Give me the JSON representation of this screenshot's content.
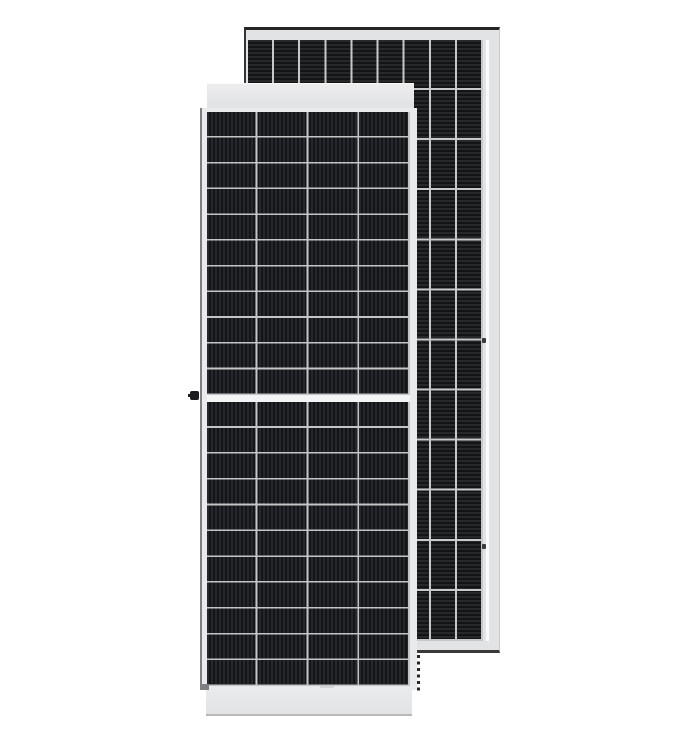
{
  "scene": {
    "type": "product-photo",
    "subject": "Two monocrystalline half-cut-cell solar photovoltaic modules; front-face panel standing in front of a rear-face panel",
    "background": "#ffffff"
  },
  "front_panel": {
    "view": "front glass face with white aluminium frame, top and bottom frame faces visible in perspective",
    "cell_columns": 4,
    "cell_rows_top_half": 11,
    "cell_rows_bottom_half": 11,
    "center_split": "horizontal white gap between upper and lower half-cell strings",
    "grounding_knob": "small black fitting on left frame edge at the center split"
  },
  "rear_panel": {
    "view": "rear side with dark cell matrix visible, light frame on right and bottom, dark outline on top and left",
    "cell_columns": 9,
    "cell_rows": 12
  },
  "grids": {
    "front_top": {
      "columns": 4,
      "rows": 11,
      "stripe_direction": "vertical",
      "cell_dark": "#141518",
      "cell_stripe": "#26272a",
      "divider_color": "#c3c5c7",
      "col_divider_px": 2,
      "row_divider_px": 1.6,
      "stripe_pitch_px": 4
    },
    "front_bottom": {
      "columns": 4,
      "rows": 11,
      "stripe_direction": "vertical",
      "cell_dark": "#141518",
      "cell_stripe": "#26272a",
      "divider_color": "#c3c5c7",
      "col_divider_px": 2,
      "row_divider_px": 1.6,
      "stripe_pitch_px": 4
    },
    "rear": {
      "columns": 9,
      "rows": 12,
      "stripe_direction": "horizontal",
      "cell_dark": "#131416",
      "cell_stripe": "#27282a",
      "divider_color": "#c6c8ca",
      "col_divider_px": 2,
      "row_divider_px": 2,
      "stripe_pitch_px": 4
    }
  },
  "colors": {
    "background": "#ffffff",
    "frame_light": "#ededee",
    "frame_mid": "#e2e3e5",
    "body_frame": "#e9eaeb",
    "white_line": "#fafbfb",
    "gap": "#f3f4f5",
    "left_edge": "#7d7f82",
    "bottom_edge": "#b7b8ba",
    "rear_top_edge": "#232527",
    "rear_left_edge": "#333537",
    "rear_bottom_edge": "#37393b",
    "rear_right_soft": "#cbccce",
    "notch": "#3a3b3d",
    "knob": "#1c1c1e"
  }
}
